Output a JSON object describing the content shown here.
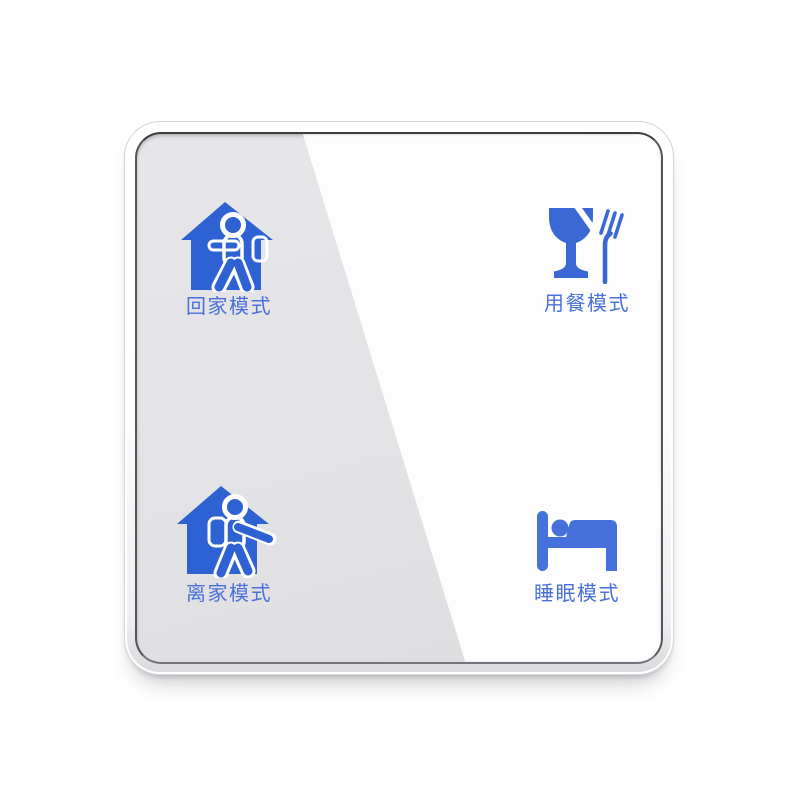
{
  "device": {
    "title": "smart scene switch panel",
    "colors": {
      "icon_blue": "#2e62d2",
      "icon_blue_mid": "#3a69d6",
      "icon_blue_light": "#4671da",
      "label_blue": "#4a70da",
      "glass_gray": "#e3e3e6",
      "reflection_white": "#fdfdfe",
      "frame_white": "#fcfcfd",
      "bezel_dark": "#55555a"
    },
    "buttons": [
      {
        "id": "home",
        "label": "回家模式",
        "icon": "return-home-icon"
      },
      {
        "id": "dining",
        "label": "用餐模式",
        "icon": "dining-icon"
      },
      {
        "id": "away",
        "label": "离家模式",
        "icon": "leave-home-icon"
      },
      {
        "id": "sleep",
        "label": "睡眠模式",
        "icon": "sleep-icon"
      }
    ]
  }
}
